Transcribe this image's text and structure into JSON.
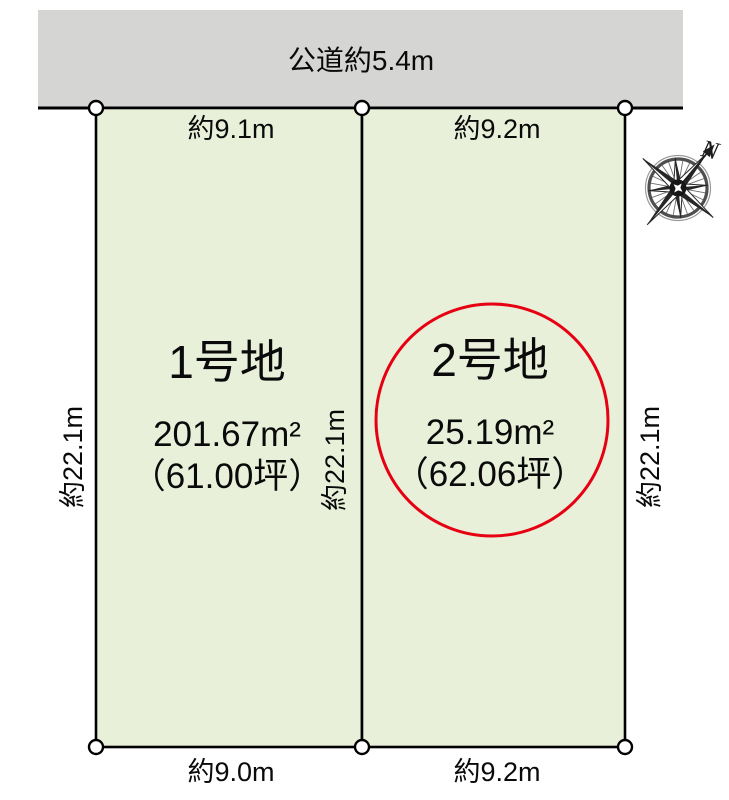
{
  "title": "区画図（土地区画レイアウト）",
  "road": {
    "label": "公道約5.4m"
  },
  "compass": {
    "north_label": "N"
  },
  "lots": [
    {
      "name": "1号地",
      "area": "201.67m²",
      "tsubo": "（61.00坪）",
      "top_dim": "約9.1m",
      "bottom_dim": "約9.0m",
      "side_dim": "約22.1m"
    },
    {
      "name": "2号地",
      "area": "25.19m²",
      "tsubo": "（62.06坪）",
      "top_dim": "約9.2m",
      "bottom_dim": "約9.2m",
      "side_dim": "約22.1m"
    }
  ],
  "side_dims": {
    "left": "約22.1m",
    "middle": "約22.1m",
    "right": "約22.1m"
  },
  "colors": {
    "road_fill": "#d5d6d4",
    "lot_fill": "#e9f0da",
    "outline": "#000000",
    "highlight_circle": "#e60012",
    "marker_fill": "#ffffff"
  }
}
